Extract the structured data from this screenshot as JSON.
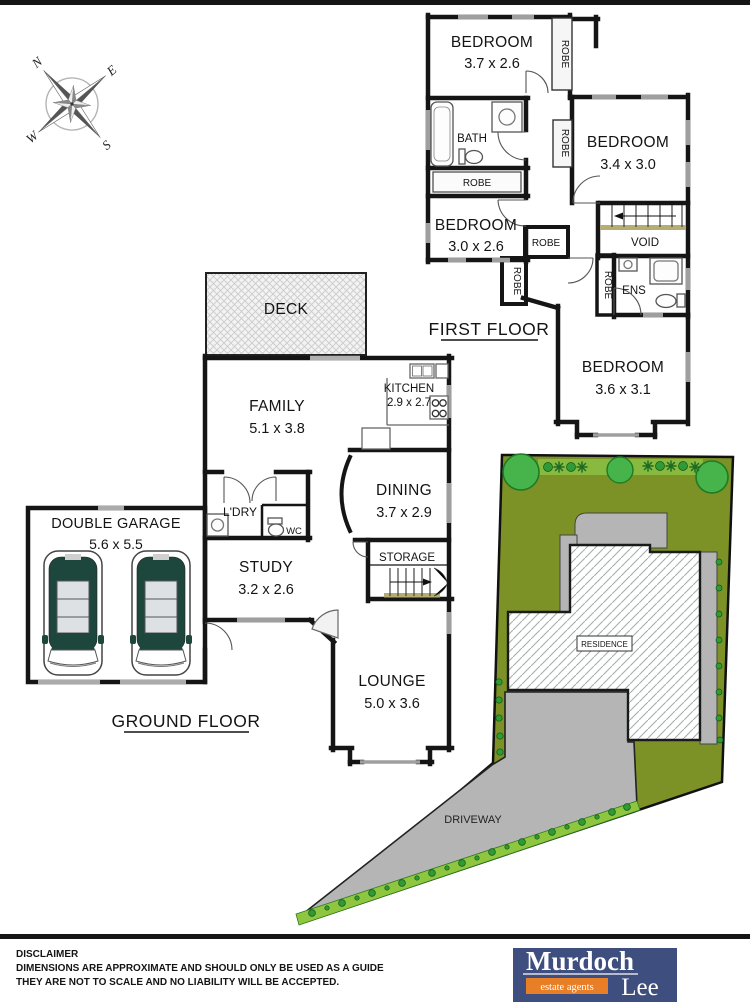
{
  "compass": {
    "n": "N",
    "e": "E",
    "s": "S",
    "w": "W"
  },
  "first_floor": {
    "label": "FIRST FLOOR",
    "bedroom1": {
      "name": "BEDROOM",
      "dims": "3.7 x 2.6"
    },
    "bedroom2": {
      "name": "BEDROOM",
      "dims": "3.4 x 3.0"
    },
    "bedroom3": {
      "name": "BEDROOM",
      "dims": "3.0 x 2.6"
    },
    "bedroom4": {
      "name": "BEDROOM",
      "dims": "3.6 x 3.1"
    },
    "bath": "BATH",
    "void": "VOID",
    "ens": "ENS",
    "robe": "ROBE"
  },
  "ground_floor": {
    "label": "GROUND FLOOR",
    "deck": "DECK",
    "family": {
      "name": "FAMILY",
      "dims": "5.1 x 3.8"
    },
    "kitchen": {
      "name": "KITCHEN",
      "dims": "2.9 x 2.7"
    },
    "dining": {
      "name": "DINING",
      "dims": "3.7 x 2.9"
    },
    "storage": "STORAGE",
    "study": {
      "name": "STUDY",
      "dims": "3.2 x 2.6"
    },
    "lounge": {
      "name": "LOUNGE",
      "dims": "5.0 x 3.6"
    },
    "laundry": "L'DRY",
    "wc": "WC",
    "garage": {
      "name": "DOUBLE GARAGE",
      "dims": "5.6 x 5.5"
    }
  },
  "site": {
    "residence": "RESIDENCE",
    "driveway": "DRIVEWAY"
  },
  "footer": {
    "disclaimer_title": "DISCLAIMER",
    "disclaimer_line1": "DIMENSIONS ARE APPROXIMATE AND SHOULD ONLY BE USED AS A GUIDE",
    "disclaimer_line2": "THEY ARE NOT TO SCALE AND NO LIABILITY WILL BE ACCEPTED."
  },
  "logo": {
    "name_top": "Murdoch",
    "name_bottom": "Lee",
    "tagline": "estate agents"
  },
  "colors": {
    "wall": "#151515",
    "window": "#9f9f9f",
    "lawn": "#7d9226",
    "path_gray": "#b5b5b5",
    "tree_green": "#46b44b",
    "shrub_strip": "#8ec63f",
    "car_body": "#1d473c",
    "stair_accent": "#b5ad72",
    "logo_navy": "#3e4e7e",
    "logo_orange": "#e87f26"
  }
}
